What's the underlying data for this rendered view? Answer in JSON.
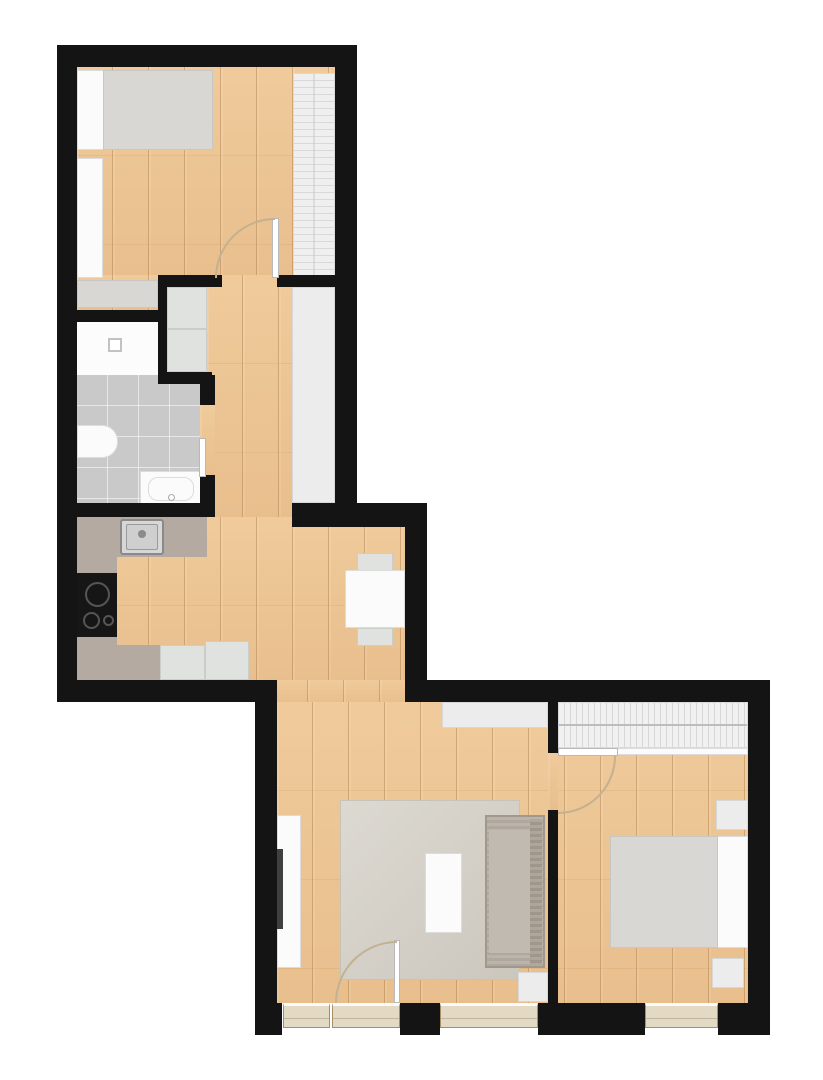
{
  "meta": {
    "title": "apartment-floor-plan",
    "canvas_width": 823,
    "canvas_height": 1080
  },
  "palette": {
    "wall": "#141414",
    "wood_floor": "#ecc494",
    "bathroom_tile": "#c9c9c9",
    "counter": "#b4aaa2",
    "furniture_white": "#fbfbfb",
    "furniture_gray": "#d9d7d3",
    "rug": "#d5d1c8",
    "couch": "#b6afa5",
    "window_sill": "#e3dac6",
    "door_swing": "#c3b191",
    "cooktop": "#161616",
    "tv": "#3f3f3f"
  },
  "rooms": [
    {
      "name": "bedroom-top"
    },
    {
      "name": "hallway"
    },
    {
      "name": "bathroom"
    },
    {
      "name": "kitchen"
    },
    {
      "name": "dining-nook"
    },
    {
      "name": "living-room"
    },
    {
      "name": "bedroom-bottom"
    }
  ],
  "elements": [
    {
      "name": "floor-bedroom-top",
      "kind": "wood",
      "x": 77,
      "y": 67,
      "w": 258,
      "h": 208
    },
    {
      "name": "floor-bedroom-top-left",
      "kind": "wood",
      "x": 77,
      "y": 275,
      "w": 81,
      "h": 35
    },
    {
      "name": "floor-hallway",
      "kind": "wood",
      "x": 207,
      "y": 275,
      "w": 85,
      "h": 242
    },
    {
      "name": "floor-kitchen-dining",
      "kind": "wood",
      "x": 77,
      "y": 517,
      "w": 328,
      "h": 163
    },
    {
      "name": "floor-passage",
      "kind": "wood",
      "x": 272,
      "y": 680,
      "w": 133,
      "h": 22
    },
    {
      "name": "floor-living-bedroom",
      "kind": "wood",
      "x": 277,
      "y": 702,
      "w": 471,
      "h": 301
    },
    {
      "name": "floor-bath-doorway",
      "kind": "wood",
      "x": 200,
      "y": 405,
      "w": 15,
      "h": 72
    },
    {
      "name": "floor-bedroom-doorway",
      "kind": "wood",
      "x": 548,
      "y": 753,
      "w": 10,
      "h": 57
    },
    {
      "name": "shower-floor",
      "kind": "shower",
      "x": 77,
      "y": 322,
      "w": 81,
      "h": 53
    },
    {
      "name": "bathroom-tile-floor",
      "kind": "tile",
      "x": 77,
      "y": 375,
      "w": 123,
      "h": 128
    },
    {
      "name": "hall-closet",
      "kind": "panel",
      "x": 292,
      "y": 287,
      "w": 43,
      "h": 216
    },
    {
      "name": "utility-box-top",
      "kind": "appliance",
      "x": 167,
      "y": 287,
      "w": 40,
      "h": 42
    },
    {
      "name": "utility-box-bottom",
      "kind": "appliance",
      "x": 167,
      "y": 329,
      "w": 40,
      "h": 43
    },
    {
      "name": "bed-top-base",
      "kind": "white",
      "x": 77,
      "y": 70,
      "w": 136,
      "h": 80
    },
    {
      "name": "bed-top-duvet",
      "kind": "gray-soft",
      "x": 103,
      "y": 70,
      "w": 110,
      "h": 80
    },
    {
      "name": "wardrobe-top-left",
      "kind": "white",
      "x": 77,
      "y": 158,
      "w": 26,
      "h": 120
    },
    {
      "name": "dresser-top",
      "kind": "gray-soft",
      "x": 77,
      "y": 280,
      "w": 81,
      "h": 28
    },
    {
      "name": "wardrobe-top-right",
      "kind": "hatch-h",
      "x": 293,
      "y": 73,
      "w": 42,
      "h": 205
    },
    {
      "name": "shower-drain",
      "kind": "drain",
      "x": 108,
      "y": 338,
      "w": 14,
      "h": 14
    },
    {
      "name": "toilet",
      "kind": "white",
      "x": 77,
      "y": 425,
      "w": 41,
      "h": 33,
      "radius": "0 16px 16px 0"
    },
    {
      "name": "bath-sink-base",
      "kind": "white",
      "x": 140,
      "y": 471,
      "w": 62,
      "h": 34
    },
    {
      "name": "bath-sink-basin",
      "kind": "white",
      "x": 148,
      "y": 477,
      "w": 46,
      "h": 24,
      "radius": "10px"
    },
    {
      "name": "bath-faucet-dot",
      "kind": "circle",
      "x": 168,
      "y": 494,
      "w": 7,
      "h": 7,
      "bc": "#aaaaaa",
      "bw": 1
    },
    {
      "name": "kitchen-counter-top",
      "kind": "counter",
      "x": 77,
      "y": 517,
      "w": 130,
      "h": 40
    },
    {
      "name": "kitchen-counter-left",
      "kind": "counter",
      "x": 77,
      "y": 557,
      "w": 40,
      "h": 123
    },
    {
      "name": "kitchen-counter-bottom",
      "kind": "counter",
      "x": 77,
      "y": 645,
      "w": 83,
      "h": 35
    },
    {
      "name": "kitchen-sink",
      "kind": "steel",
      "x": 120,
      "y": 519,
      "w": 44,
      "h": 36
    },
    {
      "name": "kitchen-sink-basin",
      "kind": "steel-inner",
      "x": 126,
      "y": 524,
      "w": 32,
      "h": 26
    },
    {
      "name": "kitchen-faucet",
      "kind": "circle-fill",
      "x": 138,
      "y": 530,
      "w": 8,
      "h": 8
    },
    {
      "name": "cooktop",
      "kind": "black",
      "x": 77,
      "y": 573,
      "w": 40,
      "h": 64
    },
    {
      "name": "burner-large",
      "kind": "circle",
      "x": 85,
      "y": 582,
      "w": 25,
      "h": 25,
      "bc": "#555555",
      "bw": 2
    },
    {
      "name": "burner-medium",
      "kind": "circle",
      "x": 83,
      "y": 612,
      "w": 17,
      "h": 17,
      "bc": "#555555",
      "bw": 2
    },
    {
      "name": "burner-small",
      "kind": "circle",
      "x": 103,
      "y": 615,
      "w": 11,
      "h": 11,
      "bc": "#555555",
      "bw": 2
    },
    {
      "name": "kitchen-appliance-1",
      "kind": "appliance",
      "x": 160,
      "y": 645,
      "w": 45,
      "h": 35
    },
    {
      "name": "kitchen-appliance-2",
      "kind": "appliance",
      "x": 205,
      "y": 641,
      "w": 44,
      "h": 39
    },
    {
      "name": "dining-chair-top",
      "kind": "appliance",
      "x": 357,
      "y": 553,
      "w": 36,
      "h": 18
    },
    {
      "name": "dining-chair-bottom",
      "kind": "appliance",
      "x": 357,
      "y": 628,
      "w": 36,
      "h": 18
    },
    {
      "name": "dining-table",
      "kind": "white",
      "x": 345,
      "y": 570,
      "w": 60,
      "h": 58
    },
    {
      "name": "living-sideboard",
      "kind": "panel",
      "x": 442,
      "y": 702,
      "w": 106,
      "h": 26
    },
    {
      "name": "tv-board",
      "kind": "white",
      "x": 277,
      "y": 815,
      "w": 24,
      "h": 153
    },
    {
      "name": "tv",
      "kind": "dark",
      "x": 277,
      "y": 849,
      "w": 6,
      "h": 80
    },
    {
      "name": "rug",
      "kind": "rug",
      "x": 340,
      "y": 800,
      "w": 180,
      "h": 180
    },
    {
      "name": "coffee-table",
      "kind": "white",
      "x": 425,
      "y": 853,
      "w": 37,
      "h": 80
    },
    {
      "name": "couch",
      "kind": "couch",
      "x": 485,
      "y": 815,
      "w": 60,
      "h": 153
    },
    {
      "name": "couch-seat",
      "kind": "couch-seat",
      "x": 489,
      "y": 830,
      "w": 41,
      "h": 123
    },
    {
      "name": "couch-back",
      "kind": "couch-back",
      "x": 530,
      "y": 819,
      "w": 12,
      "h": 145
    },
    {
      "name": "side-table",
      "kind": "panel",
      "x": 518,
      "y": 972,
      "w": 30,
      "h": 30
    },
    {
      "name": "wardrobe-bottom",
      "kind": "hatch-v",
      "x": 558,
      "y": 702,
      "w": 190,
      "h": 46
    },
    {
      "name": "wardrobe-bottom-edge",
      "kind": "white",
      "x": 558,
      "y": 748,
      "w": 190,
      "h": 7
    },
    {
      "name": "bed-bottom-base",
      "kind": "white",
      "x": 610,
      "y": 836,
      "w": 138,
      "h": 112
    },
    {
      "name": "bed-bottom-duvet",
      "kind": "gray-soft",
      "x": 610,
      "y": 836,
      "w": 108,
      "h": 112
    },
    {
      "name": "nightstand-top",
      "kind": "panel",
      "x": 716,
      "y": 800,
      "w": 32,
      "h": 30
    },
    {
      "name": "nightstand-bottom",
      "kind": "panel",
      "x": 712,
      "y": 958,
      "w": 32,
      "h": 30
    },
    {
      "name": "wall-top",
      "kind": "wall",
      "x": 57,
      "y": 45,
      "w": 300,
      "h": 22
    },
    {
      "name": "wall-left",
      "kind": "wall",
      "x": 57,
      "y": 45,
      "w": 20,
      "h": 657
    },
    {
      "name": "wall-right-upper",
      "kind": "wall",
      "x": 335,
      "y": 45,
      "w": 22,
      "h": 482
    },
    {
      "name": "wall-bedroom-top-left",
      "kind": "wall",
      "x": 77,
      "y": 310,
      "w": 81,
      "h": 12
    },
    {
      "name": "wall-bath-divider",
      "kind": "wall",
      "x": 158,
      "y": 275,
      "w": 9,
      "h": 109
    },
    {
      "name": "wall-niche-top",
      "kind": "wall",
      "x": 167,
      "y": 275,
      "w": 55,
      "h": 12
    },
    {
      "name": "wall-bedroom-top-right",
      "kind": "wall",
      "x": 277,
      "y": 275,
      "w": 58,
      "h": 12
    },
    {
      "name": "wall-niche-bottom",
      "kind": "wall",
      "x": 167,
      "y": 372,
      "w": 45,
      "h": 12
    },
    {
      "name": "wall-bath-right-a",
      "kind": "wall",
      "x": 200,
      "y": 375,
      "w": 15,
      "h": 30
    },
    {
      "name": "wall-bath-right-b",
      "kind": "wall",
      "x": 200,
      "y": 475,
      "w": 15,
      "h": 28
    },
    {
      "name": "wall-bath-bottom",
      "kind": "wall",
      "x": 57,
      "y": 503,
      "w": 158,
      "h": 14
    },
    {
      "name": "wall-closet-bottom",
      "kind": "wall",
      "x": 292,
      "y": 503,
      "w": 135,
      "h": 24
    },
    {
      "name": "wall-dining-right",
      "kind": "wall",
      "x": 405,
      "y": 503,
      "w": 22,
      "h": 199
    },
    {
      "name": "wall-kitchen-bottom",
      "kind": "wall",
      "x": 57,
      "y": 680,
      "w": 215,
      "h": 22
    },
    {
      "name": "wall-living-left",
      "kind": "wall",
      "x": 255,
      "y": 680,
      "w": 22,
      "h": 355
    },
    {
      "name": "wall-block-c-top",
      "kind": "wall",
      "x": 405,
      "y": 680,
      "w": 365,
      "h": 22
    },
    {
      "name": "wall-block-c-right",
      "kind": "wall",
      "x": 748,
      "y": 680,
      "w": 22,
      "h": 355
    },
    {
      "name": "wall-room-divider-top",
      "kind": "wall",
      "x": 548,
      "y": 702,
      "w": 10,
      "h": 51
    },
    {
      "name": "wall-room-divider-bot",
      "kind": "wall",
      "x": 548,
      "y": 810,
      "w": 10,
      "h": 193
    },
    {
      "name": "wall-bottom-1",
      "kind": "wall",
      "x": 255,
      "y": 1003,
      "w": 27,
      "h": 32
    },
    {
      "name": "wall-bottom-2",
      "kind": "wall",
      "x": 400,
      "y": 1003,
      "w": 40,
      "h": 32
    },
    {
      "name": "wall-bottom-3",
      "kind": "wall",
      "x": 538,
      "y": 1003,
      "w": 107,
      "h": 32
    },
    {
      "name": "wall-bottom-4",
      "kind": "wall",
      "x": 718,
      "y": 1003,
      "w": 52,
      "h": 32
    },
    {
      "name": "door-bedroom-top-leaf",
      "kind": "leaf",
      "x": 272,
      "y": 218,
      "w": 7,
      "h": 60
    },
    {
      "name": "door-bedroom-top-swing",
      "kind": "arc-tl",
      "x": 215,
      "y": 218,
      "w": 60,
      "h": 60
    },
    {
      "name": "door-bathroom-leaf",
      "kind": "leaf",
      "x": 199,
      "y": 438,
      "w": 7,
      "h": 39
    },
    {
      "name": "door-bedroom-bot-leaf",
      "kind": "leaf",
      "x": 558,
      "y": 748,
      "w": 60,
      "h": 8
    },
    {
      "name": "door-bedroom-bot-swing",
      "kind": "arc-br",
      "x": 558,
      "y": 756,
      "w": 58,
      "h": 58
    },
    {
      "name": "balcony-door-leaf",
      "kind": "leaf",
      "x": 394,
      "y": 940,
      "w": 6,
      "h": 63
    },
    {
      "name": "balcony-door-swing",
      "kind": "arc-tl",
      "x": 335,
      "y": 941,
      "w": 62,
      "h": 62
    },
    {
      "name": "window-balcony-sill-a",
      "kind": "sill",
      "x": 283,
      "y": 1003,
      "w": 47,
      "h": 25
    },
    {
      "name": "window-balcony-sill-b",
      "kind": "sill",
      "x": 332,
      "y": 1003,
      "w": 68,
      "h": 25
    },
    {
      "name": "window-living-sill",
      "kind": "sill",
      "x": 440,
      "y": 1003,
      "w": 98,
      "h": 25
    },
    {
      "name": "window-bedroom-sill",
      "kind": "sill",
      "x": 645,
      "y": 1003,
      "w": 73,
      "h": 25
    }
  ]
}
